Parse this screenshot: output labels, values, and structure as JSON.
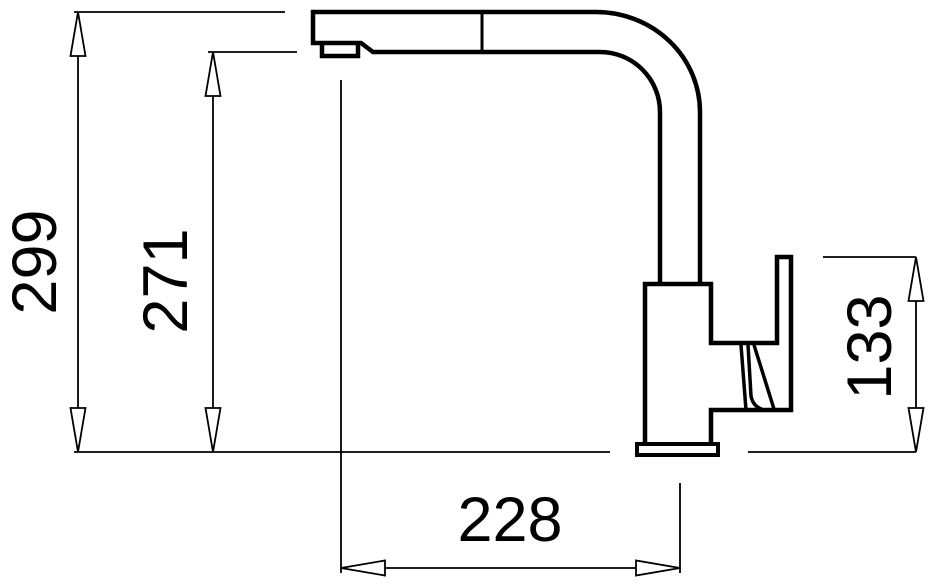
{
  "drawing": {
    "background_color": "#ffffff",
    "line_color": "#000000",
    "dimension_labels": {
      "total_height": "299",
      "spout_underside_height": "271",
      "handle_top_height": "133",
      "spout_reach": "228"
    }
  }
}
